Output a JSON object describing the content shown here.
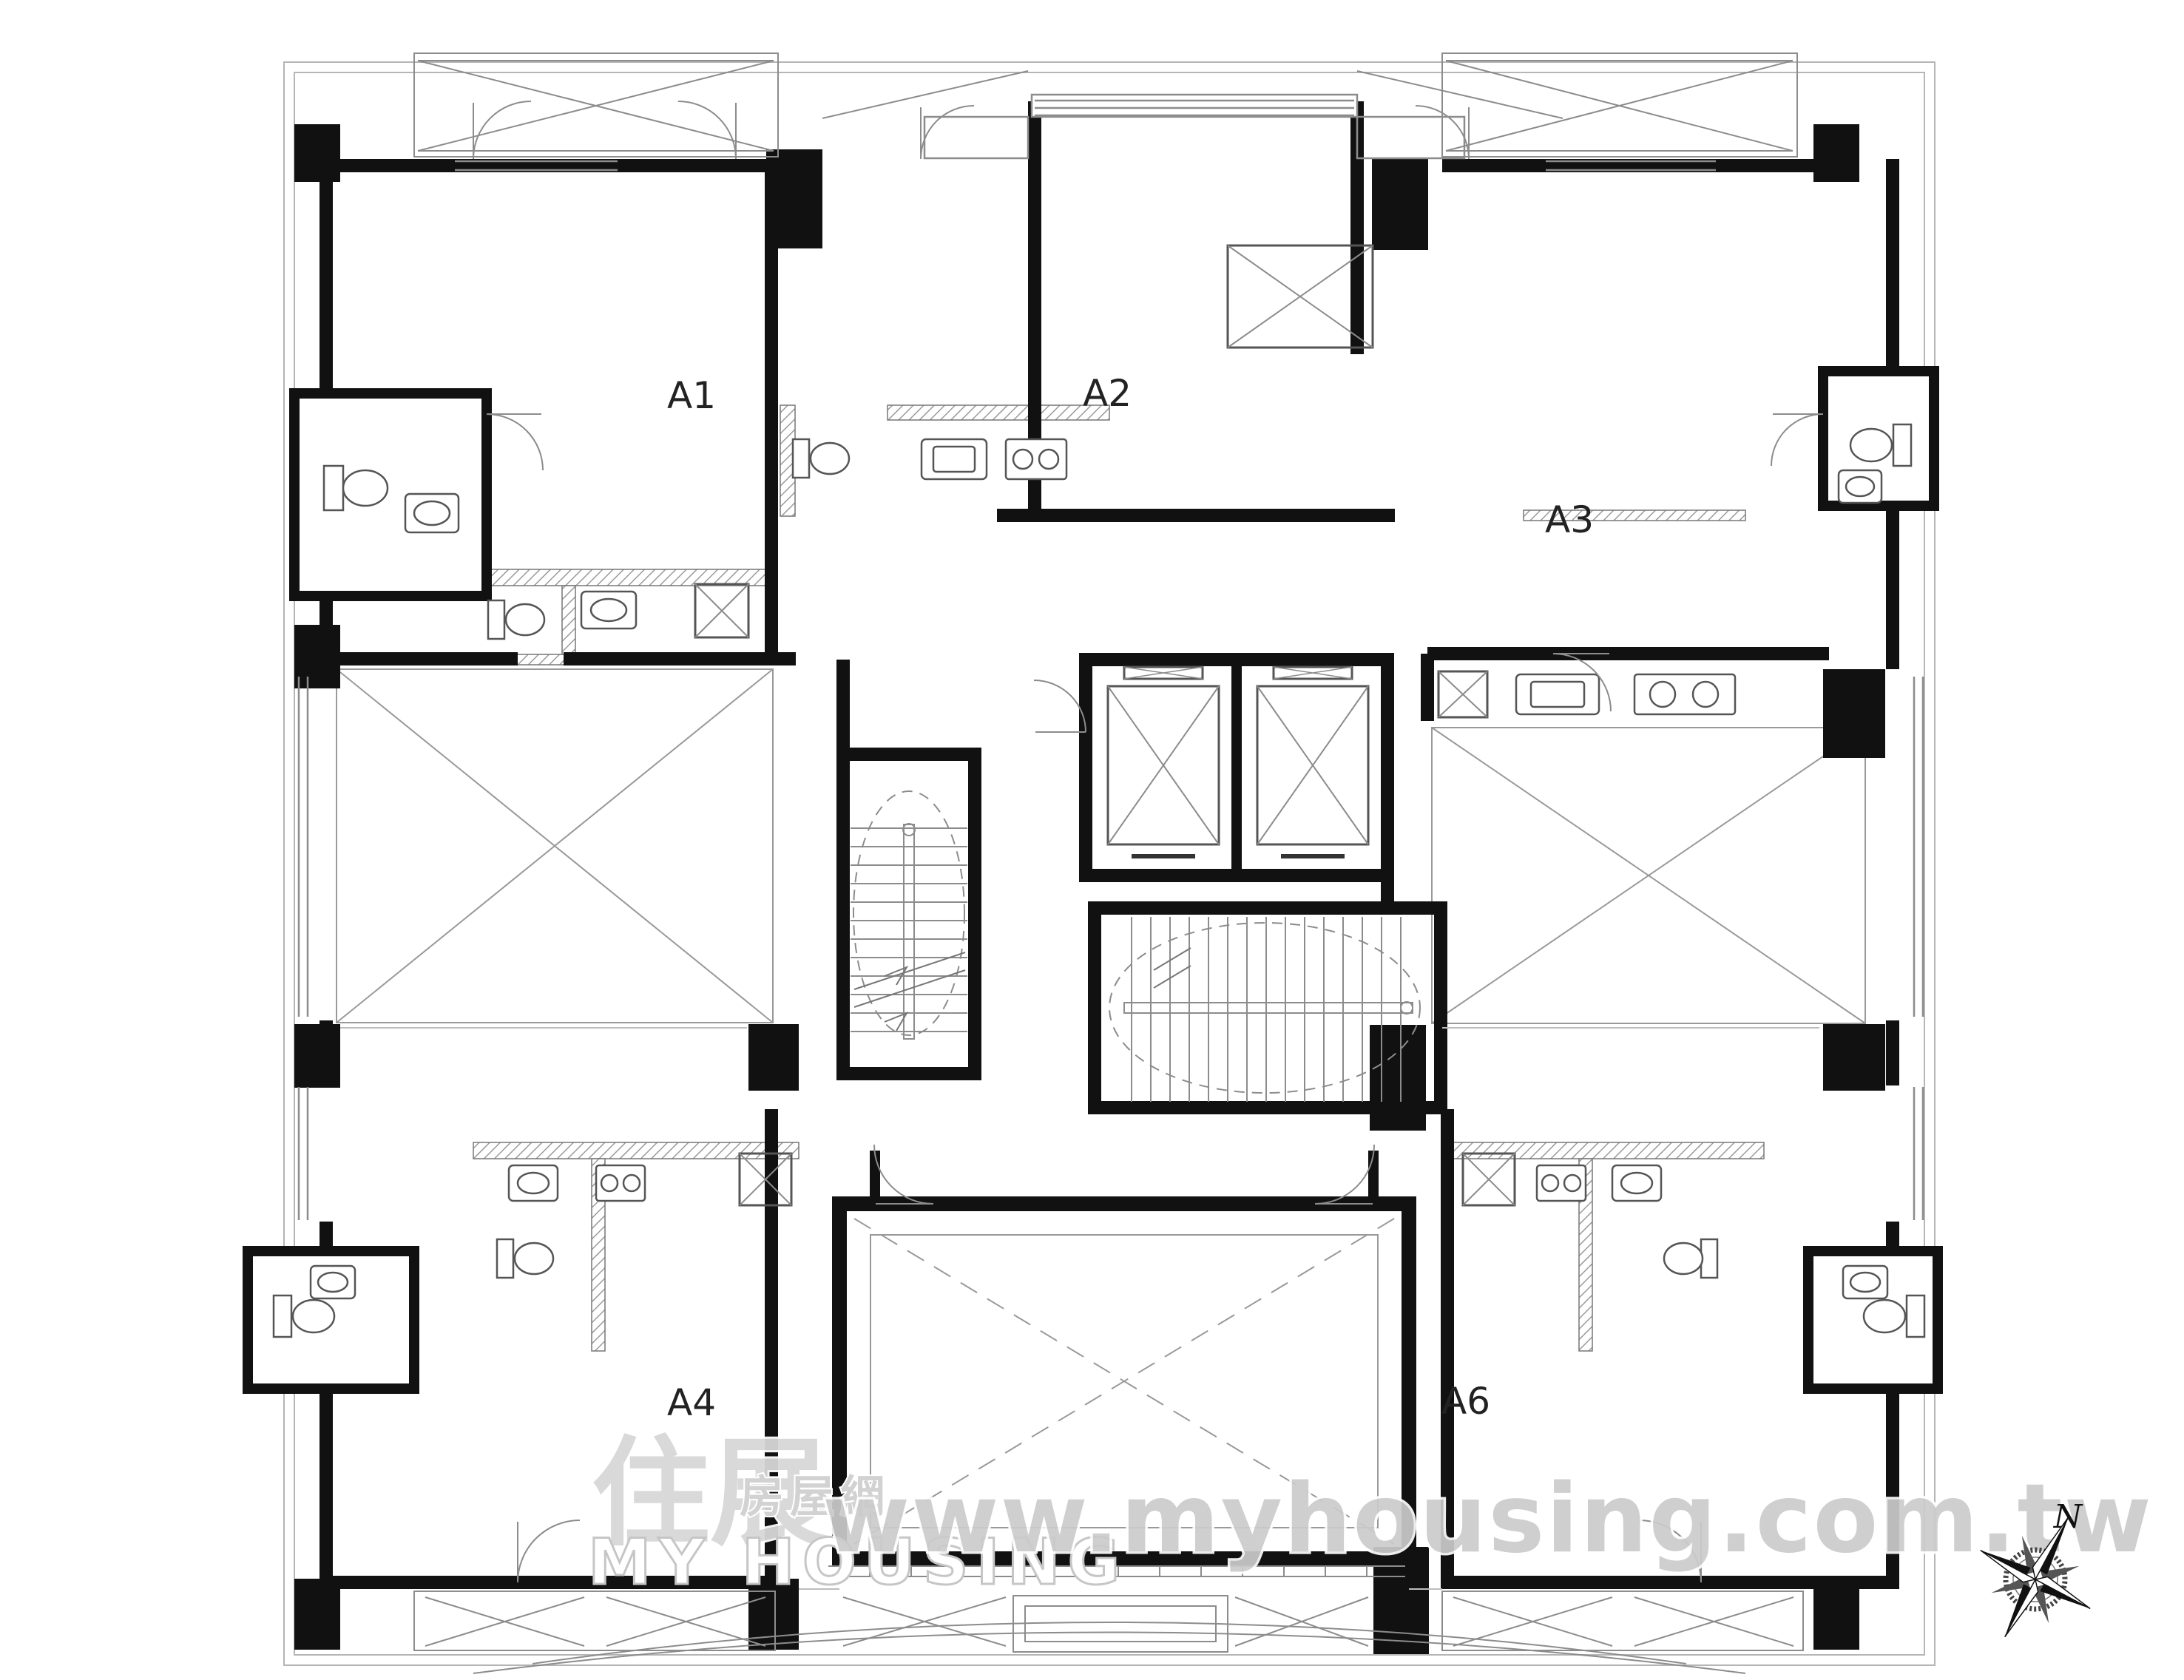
{
  "document": {
    "kind": "apartment-floor-plan",
    "background": "#ffffff"
  },
  "units": [
    {
      "id": "a1",
      "label": "A1"
    },
    {
      "id": "a2",
      "label": "A2"
    },
    {
      "id": "a3",
      "label": "A3"
    },
    {
      "id": "a4",
      "label": "A4"
    },
    {
      "id": "a6",
      "label": "A6"
    }
  ],
  "watermark": {
    "logo_cjk_main": "住展",
    "logo_cjk_sub": "房屋網",
    "logo_latin": "MY HOUSING",
    "url_text": "www.myhousing.com.tw",
    "color": "#cbcbcb"
  },
  "compass": {
    "north_label": "N"
  },
  "icons": {
    "compass_rose": "compass-rose-icon",
    "elevator": "elevator-shaft-icon",
    "stair": "staircase-icon",
    "toilet": "toilet-icon",
    "sink": "sink-icon",
    "stove": "stove-icon"
  },
  "colors": {
    "walls": "#111111",
    "thin_line": "#8c8c8c",
    "void_line": "#999999",
    "label": "#222222",
    "watermark": "#cbcbcb"
  }
}
